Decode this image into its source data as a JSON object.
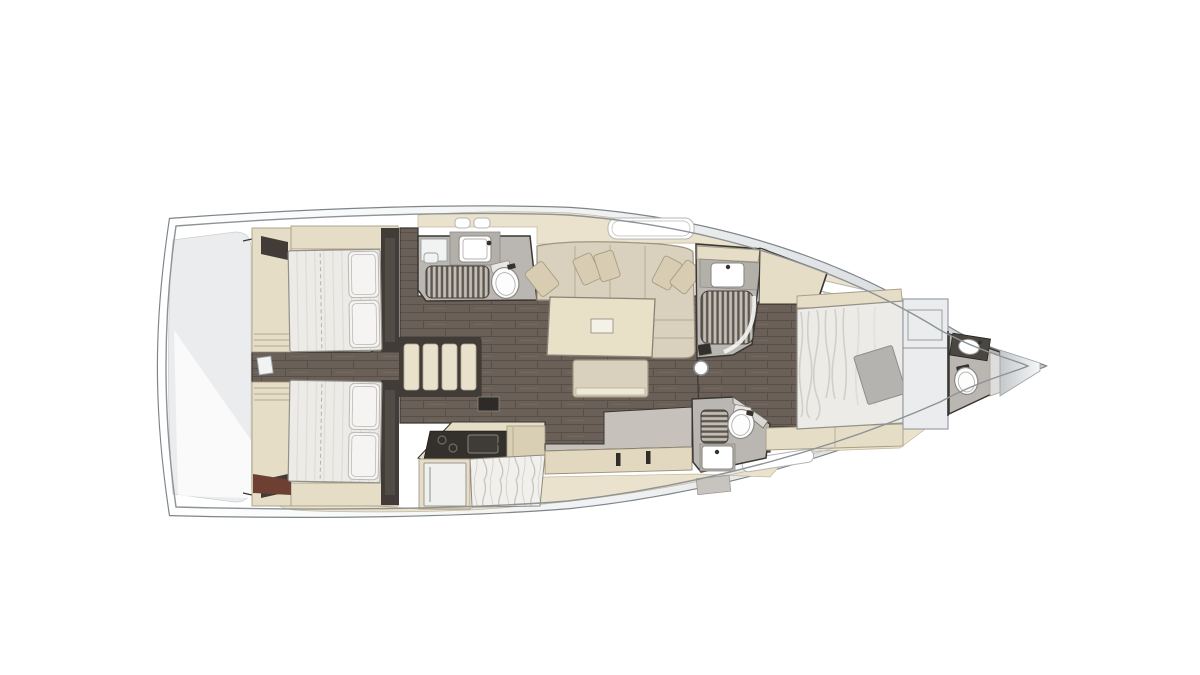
{
  "diagram": {
    "kind": "sailboat-interior-floor-plan",
    "orientation": "bow-right",
    "features": {
      "double_berths": 3,
      "aft_cabins": 2,
      "forward_cabins": 1,
      "heads": 3,
      "toilets": 3,
      "sinks": 5,
      "shower_grates": 3,
      "companionway_steps": 4,
      "salon_tables": 1,
      "sofas": 1,
      "ottomans": 1,
      "throw_pillows": 5,
      "galley_burners": 2,
      "fridges": 1,
      "masts": 1,
      "deck_hatches": 6
    }
  },
  "colors": {
    "floor": "#6b6058",
    "floor_line": "#57504a",
    "floor_joint": "#7d7166",
    "deck_cream": "#eae2cd",
    "cream": "#e6ddc6",
    "cream_dark": "#d9cfb5",
    "outline": "#3a3632",
    "furniture_stroke": "#a89e88",
    "sofa": "#d9d1bd",
    "table": "#e9e0c8",
    "mattress": "#edebe7",
    "mattress_stripe": "#dfdcd6",
    "mattress_stroke": "#94908a",
    "pillow": "#f5f4f2",
    "pillow_stroke": "#bcb9b4",
    "stairs": "#e9e1cb",
    "wall": "#413c37",
    "comp_floor": "#bab6b1",
    "counter_gray": "#b3afa9",
    "slat": "#c2bdb5",
    "slat_bg": "#5d5750",
    "toilet": "#fdfdfd",
    "toilet_stroke": "#8d8a86",
    "counter_top": "#c6c1ba",
    "counter_face": "#e2d8c0",
    "dark_counter": "#34302c",
    "marble": "#f2f0ec",
    "marble_vein": "#c8c5c0",
    "fridge": "#f0f0ee",
    "locker": "#eaecee",
    "locker_stroke": "#9aa0a4",
    "throw": "#b5b3b0",
    "transom": "#ebeced",
    "hull_stroke": "#7e8589",
    "hull_inner": "#8d9396",
    "band_dark": "#c9cdd0",
    "redwood": "#6e4034",
    "mat": "#c7c4bf",
    "white": "#ffffff",
    "mast_stroke": "#8a9094"
  }
}
